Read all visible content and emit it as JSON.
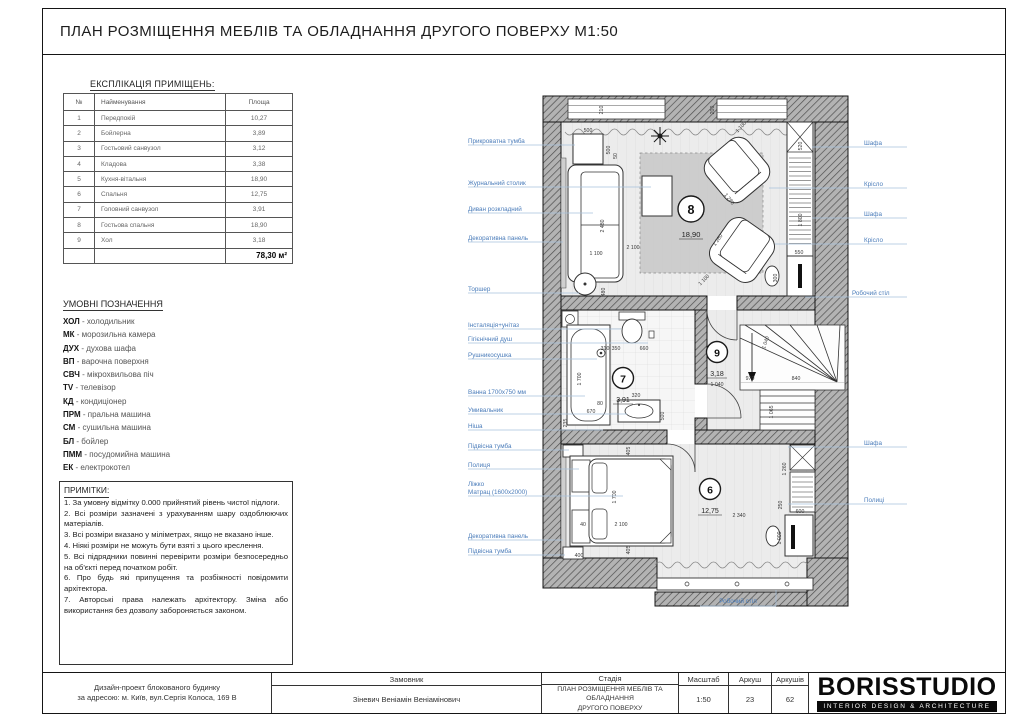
{
  "title": "ПЛАН РОЗМІЩЕННЯ МЕБЛІВ ТА ОБЛАДНАННЯ ДРУГОГО ПОВЕРХУ М1:50",
  "colors": {
    "label_blue": "#4a7cba",
    "wall_gray": "#b3b3b3",
    "logo_black": "#0a0a0a"
  },
  "explication": {
    "heading": "ЕКСПЛІКАЦІЯ ПРИМІЩЕНЬ:",
    "columns": [
      "№",
      "Найменування",
      "Площа"
    ],
    "rows": [
      [
        "1",
        "Передпокій",
        "10,27"
      ],
      [
        "2",
        "Бойлерна",
        "3,89"
      ],
      [
        "3",
        "Гостьовий санвузол",
        "3,12"
      ],
      [
        "4",
        "Кладова",
        "3,38"
      ],
      [
        "5",
        "Кухня-вітальня",
        "18,90"
      ],
      [
        "6",
        "Спальня",
        "12,75"
      ],
      [
        "7",
        "Головний санвузол",
        "3,91"
      ],
      [
        "8",
        "Гостьова спальня",
        "18,90"
      ],
      [
        "9",
        "Хол",
        "3,18"
      ]
    ],
    "total": "78,30 м²"
  },
  "legend": {
    "heading": "УМОВНІ ПОЗНАЧЕННЯ",
    "items": [
      {
        "abbr": "ХОЛ",
        "desc": "- холодильник"
      },
      {
        "abbr": "МК",
        "desc": "- морозильна камера"
      },
      {
        "abbr": "ДУХ",
        "desc": "- духова шафа"
      },
      {
        "abbr": "ВП",
        "desc": "- варочна поверхня"
      },
      {
        "abbr": "СВЧ",
        "desc": "- мікрохвильова піч"
      },
      {
        "abbr": "TV",
        "desc": "- телевізор"
      },
      {
        "abbr": "КД",
        "desc": "- кондиціонер"
      },
      {
        "abbr": "ПРМ",
        "desc": "- пральна машина"
      },
      {
        "abbr": "СМ",
        "desc": "- сушильна машина"
      },
      {
        "abbr": "БЛ",
        "desc": "- бойлер"
      },
      {
        "abbr": "ПММ",
        "desc": "- посудомийна машина"
      },
      {
        "abbr": "ЕК",
        "desc": "- електрокотел"
      }
    ]
  },
  "notes": {
    "heading": "ПРИМІТКИ:",
    "items": [
      "1. За умовну відмітку 0.000 прийнятий рівень чистої підлоги.",
      "2. Всі розміри зазначені з урахуванням шару оздоблюючих матеріалів.",
      "3. Всі розміри вказано у міліметрах, якщо не вказано інше.",
      "4. Ніякі розміри не можуть бути взяті з цього креслення.",
      "5. Всі підрядники повинні перевірити розміри безпосередньо на об'єкті перед початком робіт.",
      "6. Про будь які припущення та розбіжності повідомити архітектора.",
      "7. Авторські права належать архітектору. Зміна або використання без дозволу забороняється законом."
    ]
  },
  "plan": {
    "rooms": [
      {
        "num": "8",
        "area": "18,90"
      },
      {
        "num": "9",
        "area": "3,18"
      },
      {
        "num": "7",
        "area": "3,91"
      },
      {
        "num": "6",
        "area": "12,75"
      }
    ],
    "left_labels": [
      "Прикроватна тумба",
      "Журнальний столик",
      "Диван розкладний",
      "Декоративна панель",
      "Торшер",
      "Інсталяція+унітаз",
      "Гігієнічний душ",
      "Рушникосушка",
      "Ванна 1700х750 мм",
      "Умивальник",
      "Ніша",
      "Підвісна тумба",
      "Полиця",
      "Ліжко",
      "Матрац (1600х2000)",
      "Декоративна панель",
      "Підвісна тумба"
    ],
    "right_labels": [
      "Шафа",
      "Крісло",
      "Шафа",
      "Крісло",
      "Робочий стіл",
      "Шафа",
      "Полиці"
    ],
    "bottom_label": "Робочий стіл",
    "dims": [
      "500",
      "500",
      "50",
      "210",
      "200",
      "1 100",
      "520",
      "1 800",
      "550",
      "300",
      "1 280",
      "1 280",
      "1 100",
      "2 100",
      "2 480",
      "1 100",
      "480",
      "1 700",
      "670",
      "80",
      "235",
      "310",
      "350",
      "660",
      "320",
      "500",
      "1 040",
      "1 040",
      "970",
      "840",
      "1 065",
      "405",
      "1 700",
      "2 100",
      "40",
      "400",
      "405",
      "2 340",
      "1 260",
      "250",
      "600",
      "1 000"
    ]
  },
  "titleblock": {
    "project_line1": "Дизайн-проект блокованого будинку",
    "project_line2": "за адресою: м. Київ, вул.Сергія Колоса, 169 В",
    "customer_label": "Замовник",
    "customer": "Зіневич Веніамін Веніамінович",
    "stage_label": "Стадія",
    "stage_line1": "ПЛАН РОЗМІЩЕННЯ МЕБЛІВ ТА ОБЛАДНАННЯ",
    "stage_line2": "ДРУГОГО ПОВЕРХУ",
    "scale_label": "Масштаб",
    "scale": "1:50",
    "sheet_label": "Аркуш",
    "sheet": "23",
    "sheets_label": "Аркушів",
    "sheets": "62",
    "logo": "BORISSTUDIO",
    "logo_sub": "INTERIOR DESIGN & ARCHITECTURE"
  }
}
